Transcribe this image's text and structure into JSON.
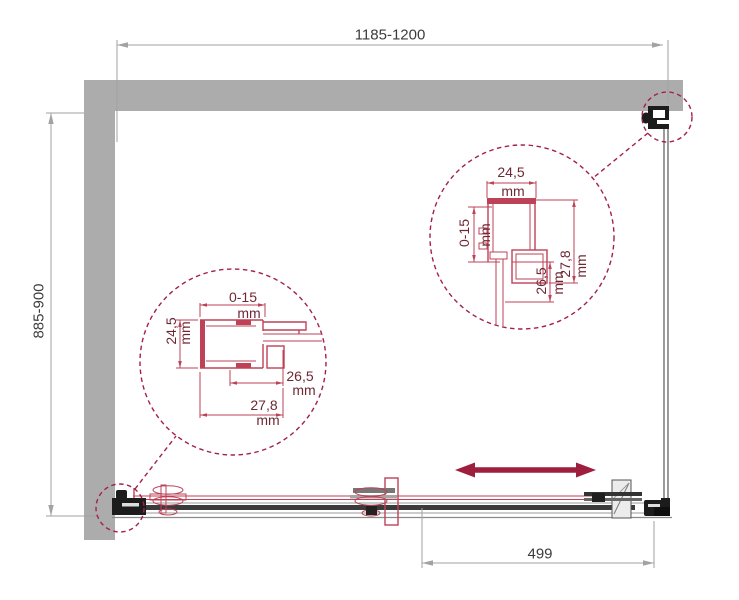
{
  "units": {
    "mm": "mm"
  },
  "dimensions": {
    "overall_width": "1185-1200",
    "overall_depth": "885-900",
    "door_offset": "499"
  },
  "detail_left": {
    "adjustment_range": "0-15",
    "profile_depth": "24,5",
    "inner_size": "26,5",
    "outer_size": "27,8"
  },
  "detail_right": {
    "profile_width": "24,5",
    "adjustment_range": "0-15",
    "inner_size": "26,5",
    "outer_size": "27,8"
  },
  "colors": {
    "wall_gray": "#ACACAC",
    "dim_line": "#A2A2A2",
    "dim_text": "#3C3C3C",
    "detail_red": "#BE4257",
    "detail_text": "#6E2833",
    "accent_crimson": "#A32148",
    "arrow_red": "#9E1E3E",
    "hardware_dark": "#1C1C1C"
  }
}
